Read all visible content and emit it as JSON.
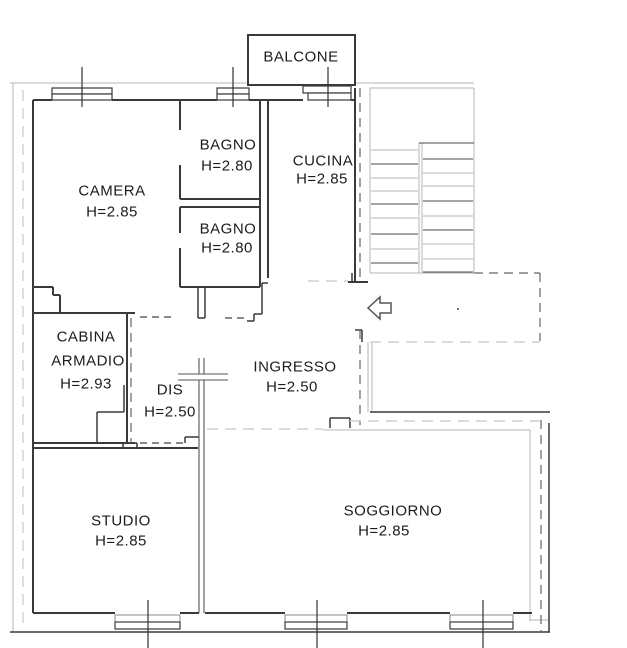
{
  "drawing": {
    "type": "apartment-floor-plan",
    "colors": {
      "background": "#ffffff",
      "wall": "#3a3a3a",
      "wall_medium": "#555555",
      "hairline": "#b5b5b5",
      "dash_dark": "#666666",
      "dash_light": "#cfcfcf",
      "text": "#1c1c1c"
    }
  },
  "rooms": {
    "balcone": {
      "label": "BALCONE"
    },
    "camera": {
      "label": "CAMERA",
      "height": "H=2.85"
    },
    "bagno1": {
      "label": "BAGNO",
      "height": "H=2.80"
    },
    "cucina": {
      "label": "CUCINA",
      "height": "H=2.85"
    },
    "bagno2": {
      "label": "BAGNO",
      "height": "H=2.80"
    },
    "cabina": {
      "label_line1": "CABINA",
      "label_line2": "ARMADIO",
      "height": "H=2.93"
    },
    "dis": {
      "label": "DIS",
      "height": "H=2.50"
    },
    "ingresso": {
      "label": "INGRESSO",
      "height": "H=2.50"
    },
    "studio": {
      "label": "STUDIO",
      "height": "H=2.85"
    },
    "soggiorno": {
      "label": "SOGGIORNO",
      "height": "H=2.85"
    }
  }
}
